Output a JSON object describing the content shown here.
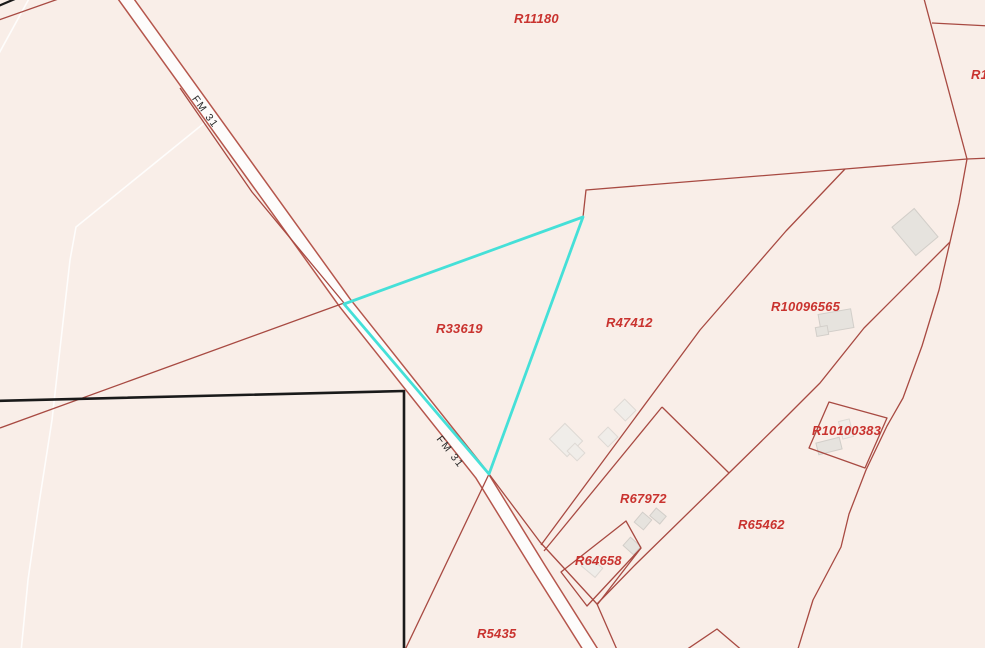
{
  "map": {
    "selected_parcel": "R33619",
    "colors": {
      "background": "#f9eee8",
      "boundary_line": "#a84a42",
      "road_casing": "#b5564c",
      "road_fill": "#fdfcfb",
      "parcel_label": "#c9332f",
      "road_label": "#2b2b2b",
      "highlight": "#45e0d8",
      "black_outline": "#1a1a1a",
      "faint_line": "#ffffff",
      "building_gray_fill": "#e6e3de",
      "building_gray_stroke": "#d2cec9",
      "building_light_fill": "#f0ede9",
      "building_light_stroke": "#ded9d4"
    },
    "parcel_labels": [
      {
        "id": "R11180",
        "x": 514,
        "y": 11
      },
      {
        "id": "R33619",
        "x": 436,
        "y": 321
      },
      {
        "id": "R47412",
        "x": 606,
        "y": 315
      },
      {
        "id": "R10096565",
        "x": 771,
        "y": 299
      },
      {
        "id": "R10100383",
        "x": 812,
        "y": 423
      },
      {
        "id": "R67972",
        "x": 620,
        "y": 491
      },
      {
        "id": "R65462",
        "x": 738,
        "y": 517
      },
      {
        "id": "R64658",
        "x": 575,
        "y": 553
      },
      {
        "id": "R5435",
        "x": 477,
        "y": 626
      }
    ],
    "partial_labels": [
      {
        "id": "4",
        "x": -7,
        "y": 232
      },
      {
        "id": "R1",
        "x": 971,
        "y": 67
      }
    ],
    "road_labels": [
      {
        "text": "FM 31",
        "cx": 205,
        "cy": 112,
        "angle": 54
      },
      {
        "text": "FM 31",
        "cx": 450,
        "cy": 452,
        "angle": 52
      }
    ],
    "geometry": {
      "road_centerline": [
        [
          121,
          -8
        ],
        [
          345,
          303
        ],
        [
          481,
          474
        ],
        [
          539,
          568
        ],
        [
          592,
          652
        ]
      ],
      "road_casing_width": 14.5,
      "road_width": 11.5,
      "highlight_polygon": [
        [
          344,
          304
        ],
        [
          583,
          217
        ],
        [
          489,
          474
        ]
      ],
      "black_outline_polygon": [
        [
          -8,
          401
        ],
        [
          404,
          391
        ],
        [
          404,
          655
        ],
        [
          -8,
          655
        ]
      ],
      "black_corner_segment": [
        [
          -4,
          7
        ],
        [
          22,
          -4
        ]
      ],
      "faint_line": [
        [
          208,
          120
        ],
        [
          76,
          227
        ],
        [
          70,
          260
        ],
        [
          52,
          420
        ],
        [
          38,
          510
        ],
        [
          28,
          580
        ],
        [
          21,
          652
        ]
      ],
      "faint_corner_segment": [
        [
          -3,
          57
        ],
        [
          30,
          -3
        ]
      ],
      "boundaries": [
        {
          "points": [
            [
              344,
              303
            ],
            [
              0,
              428
            ]
          ]
        },
        {
          "points": [
            [
              344,
              303
            ],
            [
              252,
              192
            ],
            [
              180,
              88
            ]
          ]
        },
        {
          "points": [
            [
              583,
              217
            ],
            [
              586,
              190
            ],
            [
              845,
              169
            ],
            [
              967,
              159
            ],
            [
              990,
              158
            ]
          ]
        },
        {
          "points": [
            [
              923,
              -5
            ],
            [
              967,
              159
            ]
          ]
        },
        {
          "points": [
            [
              932,
              23
            ],
            [
              990,
              26
            ]
          ]
        },
        {
          "points": [
            [
              967,
              159
            ],
            [
              959,
              203
            ],
            [
              950,
              242
            ],
            [
              939,
              290
            ],
            [
              922,
              346
            ],
            [
              903,
              398
            ],
            [
              887,
              426
            ],
            [
              866,
              470
            ],
            [
              849,
              514
            ],
            [
              841,
              547
            ],
            [
              813,
              600
            ],
            [
              797,
              652
            ]
          ]
        },
        {
          "points": [
            [
              950,
              242
            ],
            [
              864,
              328
            ],
            [
              820,
              383
            ],
            [
              781,
              422
            ],
            [
              729,
              473
            ],
            [
              636,
              564
            ],
            [
              597,
              604
            ]
          ]
        },
        {
          "points": [
            [
              845,
              169
            ],
            [
              786,
              231
            ],
            [
              700,
              330
            ],
            [
              541,
              545
            ]
          ]
        },
        {
          "points": [
            [
              662,
              407
            ],
            [
              544,
              551
            ]
          ]
        },
        {
          "points": [
            [
              662,
              407
            ],
            [
              729,
              473
            ]
          ]
        },
        {
          "points": [
            [
              829,
              402
            ],
            [
              887,
              418
            ],
            [
              865,
              468
            ],
            [
              809,
              448
            ]
          ],
          "closed": true
        },
        {
          "points": [
            [
              626,
              521
            ],
            [
              641,
              548
            ],
            [
              587,
              606
            ],
            [
              561,
              572
            ]
          ],
          "closed": true
        },
        {
          "points": [
            [
              641,
              548
            ],
            [
              597,
              605
            ]
          ]
        },
        {
          "points": [
            [
              489,
              474
            ],
            [
              404,
              652
            ]
          ]
        },
        {
          "points": [
            [
              489,
              474
            ],
            [
              540,
              542
            ],
            [
              597,
              604
            ],
            [
              618,
              652
            ]
          ]
        },
        {
          "points": [
            [
              683,
              652
            ],
            [
              717,
              629
            ],
            [
              744,
              652
            ]
          ]
        },
        {
          "points": [
            [
              -4,
              21
            ],
            [
              64,
              -3
            ]
          ]
        }
      ],
      "buildings": [
        {
          "x": 915,
          "y": 232,
          "w": 29,
          "h": 37,
          "r": -40,
          "tone": "gray"
        },
        {
          "x": 836,
          "y": 321,
          "w": 33,
          "h": 19,
          "r": -10,
          "tone": "gray"
        },
        {
          "x": 822,
          "y": 331,
          "w": 12,
          "h": 9,
          "r": -10,
          "tone": "gray"
        },
        {
          "x": 829,
          "y": 446,
          "w": 24,
          "h": 12,
          "r": -14,
          "tone": "gray"
        },
        {
          "x": 846,
          "y": 429,
          "w": 11,
          "h": 18,
          "r": -14,
          "tone": "light"
        },
        {
          "x": 566,
          "y": 440,
          "w": 25,
          "h": 22,
          "r": 45,
          "tone": "light"
        },
        {
          "x": 576,
          "y": 452,
          "w": 14,
          "h": 11,
          "r": 45,
          "tone": "light"
        },
        {
          "x": 608,
          "y": 437,
          "w": 14,
          "h": 14,
          "r": 45,
          "tone": "light"
        },
        {
          "x": 625,
          "y": 410,
          "w": 16,
          "h": 15,
          "r": 45,
          "tone": "light"
        },
        {
          "x": 643,
          "y": 521,
          "w": 12,
          "h": 13,
          "r": 40,
          "tone": "gray"
        },
        {
          "x": 658,
          "y": 516,
          "w": 13,
          "h": 10,
          "r": 40,
          "tone": "gray"
        },
        {
          "x": 632,
          "y": 546,
          "w": 14,
          "h": 11,
          "r": 42,
          "tone": "gray"
        },
        {
          "x": 592,
          "y": 567,
          "w": 18,
          "h": 12,
          "r": 40,
          "tone": "light"
        }
      ]
    }
  }
}
